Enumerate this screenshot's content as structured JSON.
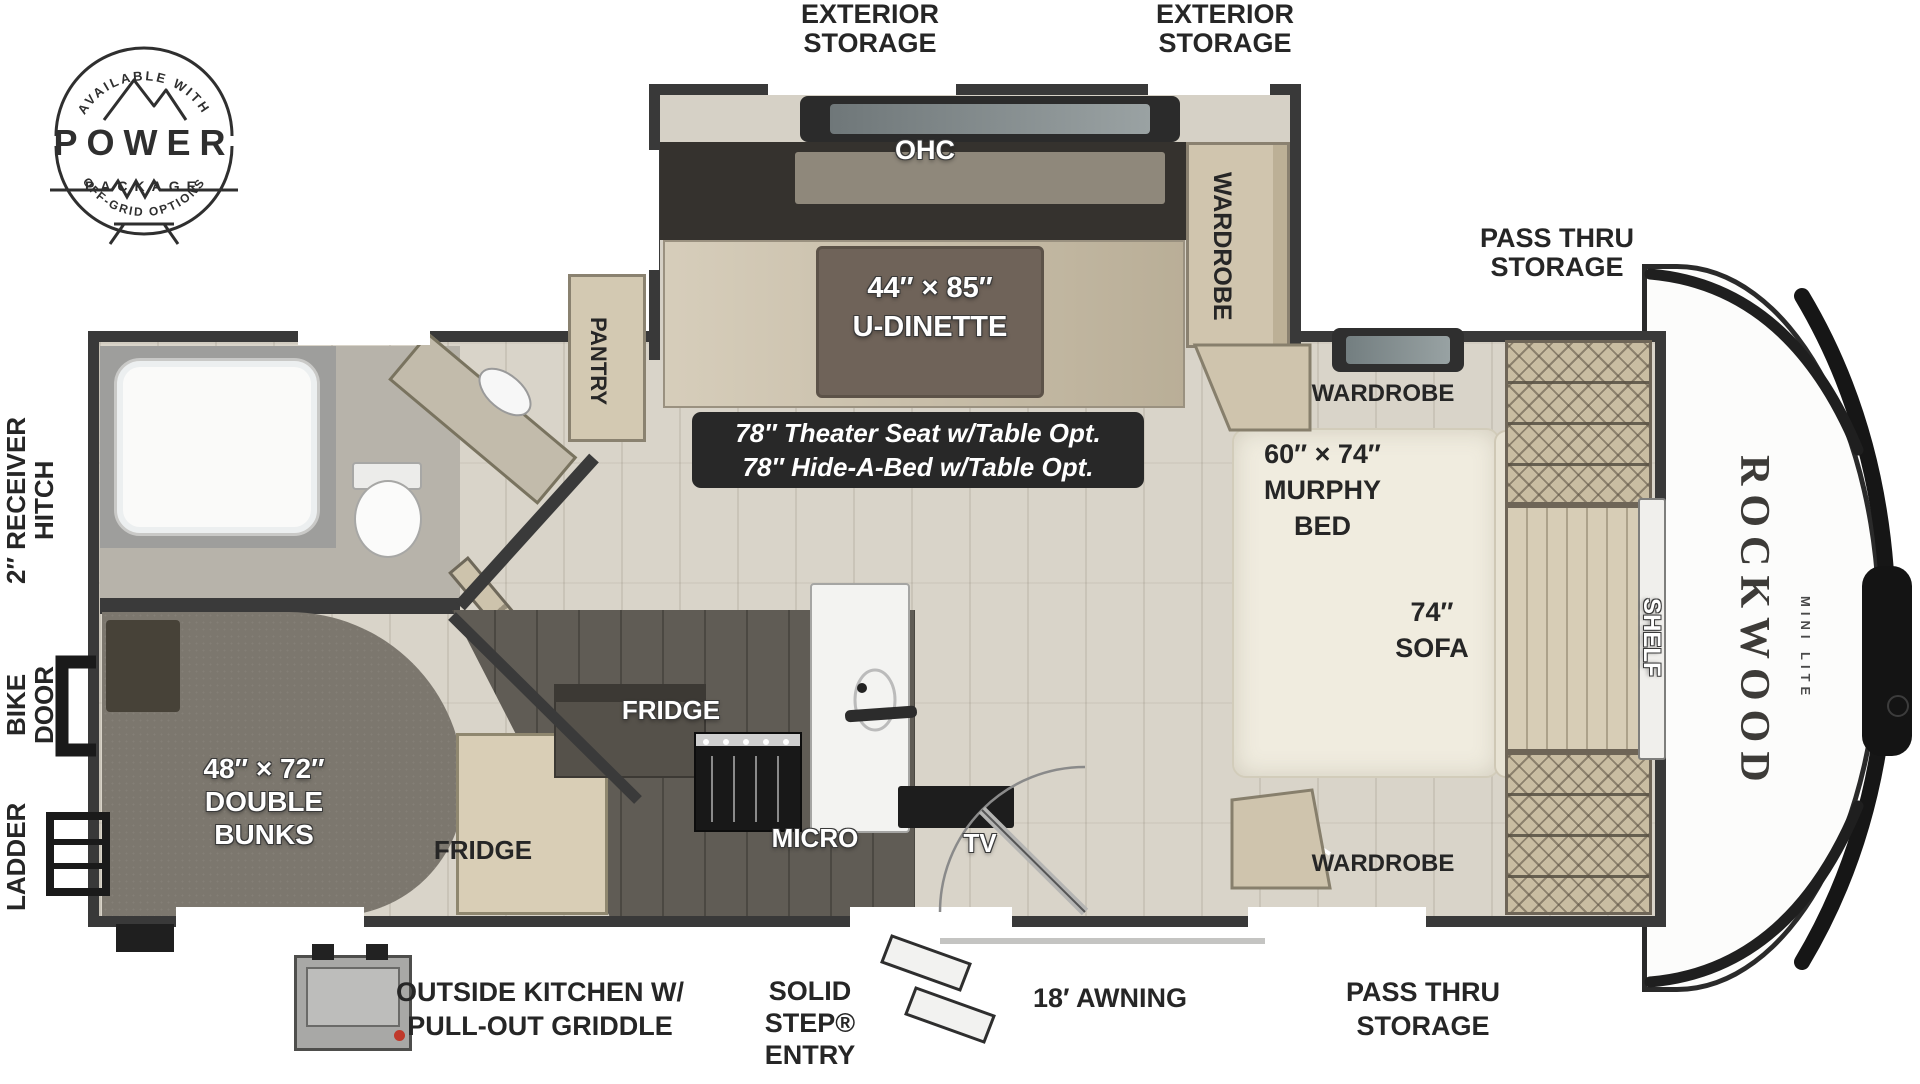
{
  "badge": {
    "arc_top": "AVAILABLE WITH",
    "title": "POWER",
    "subtitle": "PACKAGE",
    "arc_bottom": "OFF-GRID OPTIONS"
  },
  "ext": {
    "storage_left": {
      "l1": "EXTERIOR",
      "l2": "STORAGE"
    },
    "storage_right": {
      "l1": "EXTERIOR",
      "l2": "STORAGE"
    },
    "pass_thru_top": {
      "l1": "PASS THRU",
      "l2": "STORAGE"
    },
    "pass_thru_bottom": {
      "l1": "PASS THRU",
      "l2": "STORAGE"
    },
    "receiver_hitch": {
      "l1": "2″ RECEIVER",
      "l2": "HITCH"
    },
    "bike_door": {
      "l1": "BIKE",
      "l2": "DOOR"
    },
    "ladder": "LADDER",
    "awning": "18′ AWNING",
    "solid_step": {
      "l1": "SOLID",
      "l2": "STEP®",
      "l3": "ENTRY"
    },
    "outside_kitchen": {
      "l1": "OUTSIDE KITCHEN W/",
      "l2": "PULL-OUT GRIDDLE"
    }
  },
  "int": {
    "ohc": "OHC",
    "u_dinette": {
      "size": "44″ × 85″",
      "name": "U-DINETTE"
    },
    "wardrobe_slide": "WARDROBE",
    "pantry": "PANTRY",
    "option_note": {
      "l1": "78″ Theater Seat w/Table Opt.",
      "l2": "78″ Hide-A-Bed w/Table Opt."
    },
    "wardrobe_front_top": "WARDROBE",
    "wardrobe_front_bottom": "WARDROBE",
    "murphy": {
      "size": "60″ × 74″",
      "l1": "MURPHY",
      "l2": "BED"
    },
    "sofa": {
      "size": "74″",
      "name": "SOFA"
    },
    "shelf": "SHELF",
    "fridge_upper": "FRIDGE",
    "fridge_lower": "FRIDGE",
    "micro": "MICRO",
    "tv": "TV",
    "bunks": {
      "size": "48″ × 72″",
      "l1": "DOUBLE",
      "l2": "BUNKS"
    }
  },
  "brand": {
    "model": "ROCKWOOD",
    "trim": "MINI LITE"
  },
  "colors": {
    "wall": "#3a3a3a",
    "floor": "#d9d4c9",
    "carpet": "#7c776e",
    "cabinet_tan": "#d0c5ae",
    "counter_dark": "#605c55",
    "table_brown": "#6f6359",
    "note_box": "#282828",
    "knob_red": "#c0392b"
  }
}
